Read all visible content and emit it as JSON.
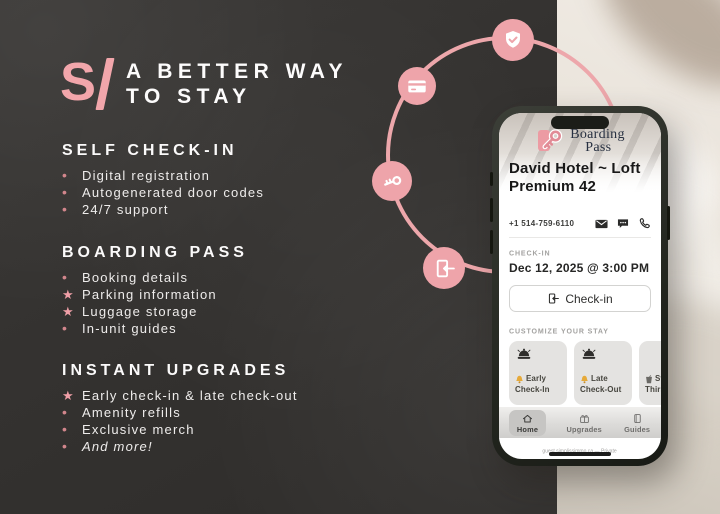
{
  "brand": {
    "logo_s": "S",
    "logo_i": "I",
    "title1": "A BETTER WAY",
    "title2": "TO STAY"
  },
  "sections": [
    {
      "heading": "SELF CHECK-IN",
      "items": [
        {
          "marker": "•",
          "text": "Digital registration"
        },
        {
          "marker": "•",
          "text": "Autogenerated door codes"
        },
        {
          "marker": "•",
          "text": "24/7 support"
        }
      ]
    },
    {
      "heading": "BOARDING PASS",
      "items": [
        {
          "marker": "•",
          "text": "Booking details"
        },
        {
          "marker": "★",
          "text": "Parking information"
        },
        {
          "marker": "★",
          "text": "Luggage storage"
        },
        {
          "marker": "•",
          "text": "In-unit guides"
        }
      ]
    },
    {
      "heading": "INSTANT UPGRADES",
      "items": [
        {
          "marker": "★",
          "text": "Early check-in & late check-out"
        },
        {
          "marker": "•",
          "text": "Amenity refills"
        },
        {
          "marker": "•",
          "text": "Exclusive merch"
        },
        {
          "marker": "•",
          "text": "And more!"
        }
      ]
    }
  ],
  "decor": {
    "badges": [
      "shield-check",
      "credit-card",
      "key",
      "door-entry"
    ]
  },
  "phone_app": {
    "logo_line1": "Boarding",
    "logo_line2": "Pass",
    "property_name": "David Hotel ~ Loft Premium 42",
    "contact_number": "+1 514-759-6110",
    "contact_icons": [
      "mail",
      "chat",
      "call"
    ],
    "checkin_label": "CHECK-IN",
    "checkin_time": "Dec 12, 2025 @ 3:00 PM",
    "checkin_button": "Check-in",
    "customize_label": "CUSTOMIZE YOUR STAY",
    "cards": [
      {
        "line1": "Early",
        "line2": "Check-In",
        "glyph": "bell"
      },
      {
        "line1": "Late",
        "line2": "Check-Out",
        "glyph": "bell"
      },
      {
        "line1": "Still",
        "line2": "Thirsty",
        "glyph": "drink"
      }
    ],
    "nav": [
      {
        "label": "Home",
        "icon": "home"
      },
      {
        "label": "Upgrades",
        "icon": "gift"
      },
      {
        "label": "Guides",
        "icon": "book"
      }
    ],
    "url": "guest.simplissimmo.ca — Private"
  },
  "colors": {
    "accent_pink": "#eea4aa",
    "bg_dark": "#343230",
    "star_pink": "#f09fa7",
    "dot_red": "#d2868c"
  }
}
